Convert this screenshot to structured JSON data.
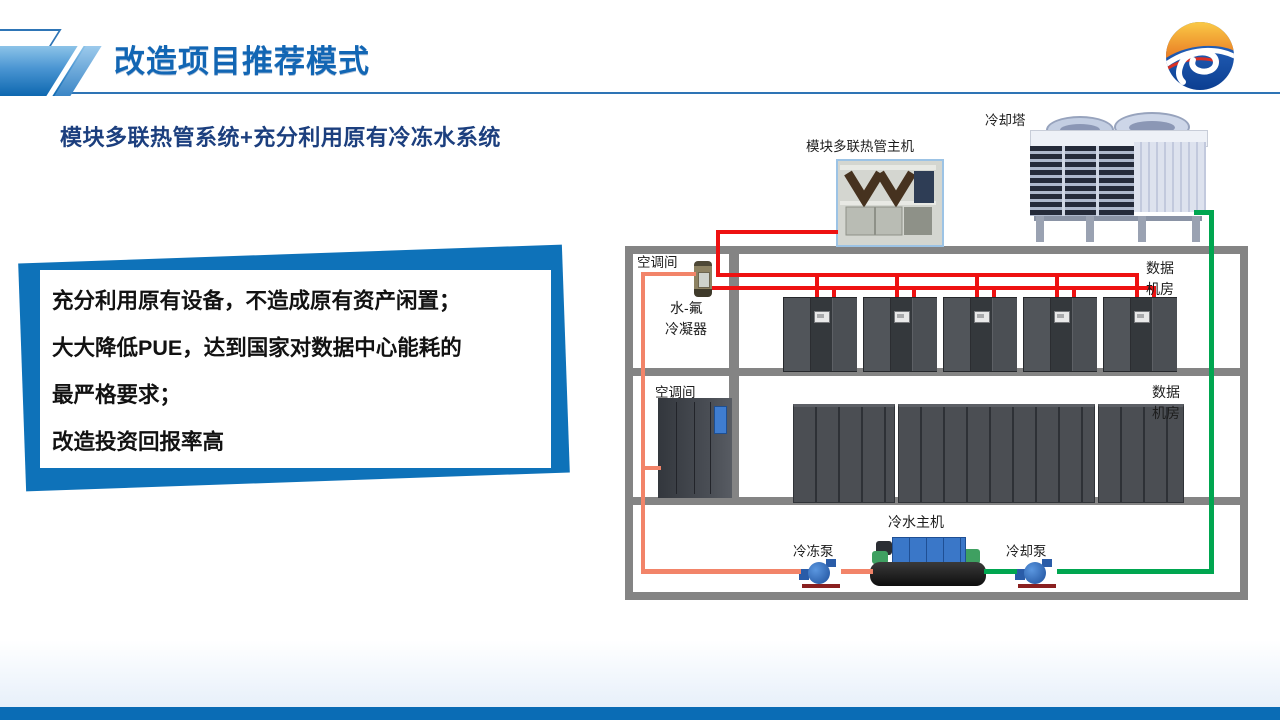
{
  "header": {
    "title": "改造项目推荐模式",
    "logo_icon": "jp-circle-globe-logo"
  },
  "subtitle": "模块多联热管系统+充分利用原有冷冻水系统",
  "highlight_box": {
    "lines": [
      "充分利用原有设备，不造成原有资产闲置；",
      "大大降低PUE，达到国家对数据中心能耗的",
      "最严格要求；",
      "改造投资回报率高"
    ]
  },
  "diagram": {
    "labels": {
      "cooling_tower": "冷却塔",
      "heat_pipe_host": "模块多联热管主机",
      "ac_room_floor1": "空调间",
      "ac_room_floor2": "空调间",
      "condenser": [
        "水-氟",
        "冷凝器"
      ],
      "data_room_floor1": [
        "数据",
        "机房"
      ],
      "data_room_floor2": [
        "数据",
        "机房"
      ],
      "chiller": "冷水主机",
      "chilled_water_pump": "冷冻泵",
      "cooling_water_pump": "冷却泵"
    },
    "colors": {
      "refrigerant_pipe_red": "#ee1111",
      "chilled_water_pipe_orange": "#f28469",
      "cooling_water_pipe_green": "#00a650",
      "wall_gray": "#848484"
    }
  },
  "theme": {
    "title_blue": "#1266b4",
    "subtitle_navy": "#1c3f7e",
    "accent_blue": "#0e72b9",
    "header_rule_blue": "#2e74b5",
    "footer_bar_blue": "#0a6cb5"
  }
}
